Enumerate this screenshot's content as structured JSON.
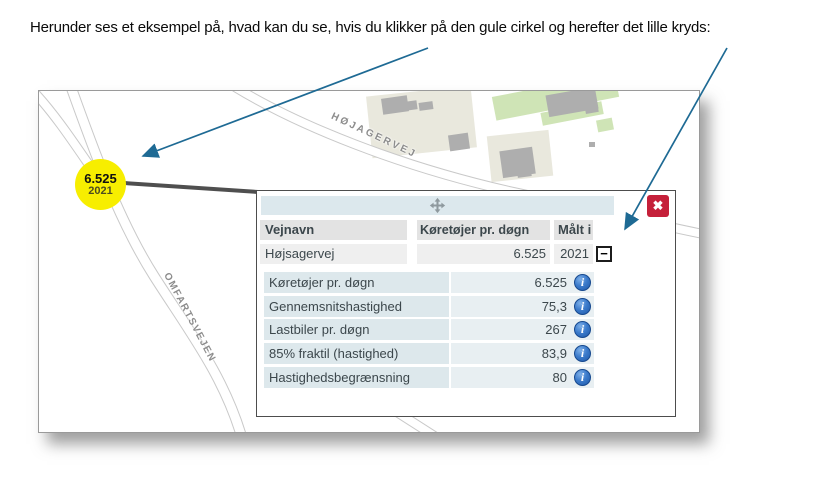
{
  "intro": {
    "text": "Herunder ses et eksempel på, hvad kan du se, hvis du klikker på den gule cirkel og herefter det lille kryds:"
  },
  "map": {
    "marker": {
      "value": "6.525",
      "year": "2021"
    },
    "road_labels": {
      "hojagervej": "HØJAGERVEJ",
      "omfartsvejen": "OMFARTSVEJEN"
    }
  },
  "popup": {
    "close_glyph": "✖",
    "collapse_glyph": "−",
    "info_glyph": "i",
    "table": {
      "columns": {
        "vejnavn": "Vejnavn",
        "koretojer": "Køretøjer pr. døgn",
        "malt_i": "Målt i"
      },
      "row": {
        "vejnavn": "Højsagervej",
        "koretojer": "6.525",
        "malt_i": "2021"
      }
    },
    "details": [
      {
        "label": "Køretøjer pr. døgn",
        "value": "6.525"
      },
      {
        "label": "Gennemsnitshastighed",
        "value": "75,3"
      },
      {
        "label": "Lastbiler pr. døgn",
        "value": "267"
      },
      {
        "label": "85% fraktil (hastighed)",
        "value": "83,9"
      },
      {
        "label": "Hastighedsbegrænsning",
        "value": "80"
      }
    ]
  },
  "colors": {
    "marker_yellow": "#f7ee00",
    "close_red": "#c5203a",
    "info_blue": "#1d58a8",
    "arrow_blue": "#1e6a94",
    "detail_label_bg": "#dde8ec",
    "detail_value_bg": "#e8eff2"
  }
}
